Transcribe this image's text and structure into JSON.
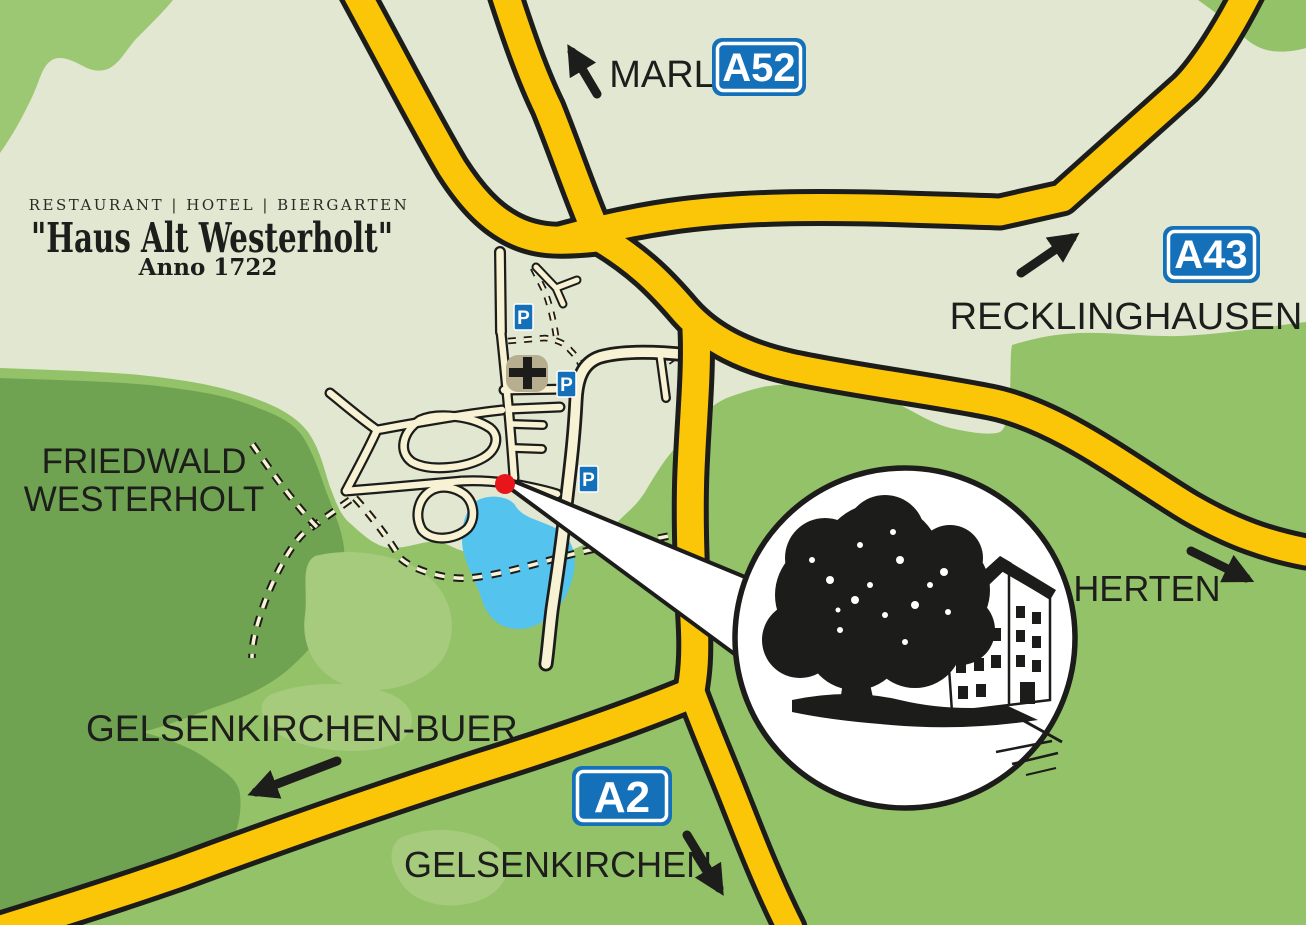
{
  "map": {
    "title": {
      "tagline": "RESTAURANT  |  HOTEL  |  BIERGARTEN",
      "name": "\"Haus Alt Westerholt\"",
      "anno": "Anno 1722"
    },
    "places": {
      "marl": "MARL",
      "recklinghausen": "RECKLINGHAUSEN",
      "herten": "HERTEN",
      "gelsenkirchen_buer": "GELSENKIRCHEN-BUER",
      "gelsenkirchen": "GELSENKIRCHEN",
      "friedwald_line1": "FRIEDWALD",
      "friedwald_line2": "WESTERHOLT"
    },
    "motorways": {
      "a52": "A52",
      "a43": "A43",
      "a2": "A2"
    },
    "parking_label": "P",
    "icons": {
      "arrows": [
        "up-left-arrow",
        "up-right-arrow",
        "down-right-arrow",
        "down-left-arrow",
        "down-right-arrow"
      ],
      "church": "church-cross-icon",
      "marker": "location-dot",
      "inset": "building-with-tree-illustration"
    },
    "colors": {
      "background_sage": "#e1e7d0",
      "green_main": "#94c269",
      "green_dark": "#6fa352",
      "green_light": "#a7cb7d",
      "green_corner": "#9cc873",
      "road_yellow": "#fcc608",
      "road_casing": "#1c1c1a",
      "street_cream": "#f7f2d4",
      "pond_blue": "#54c3ee",
      "sign_blue": "#1470b8",
      "marker_red": "#e8161b",
      "church_tan": "#b7ad8f",
      "label_ink": "#1d1d1b"
    }
  }
}
